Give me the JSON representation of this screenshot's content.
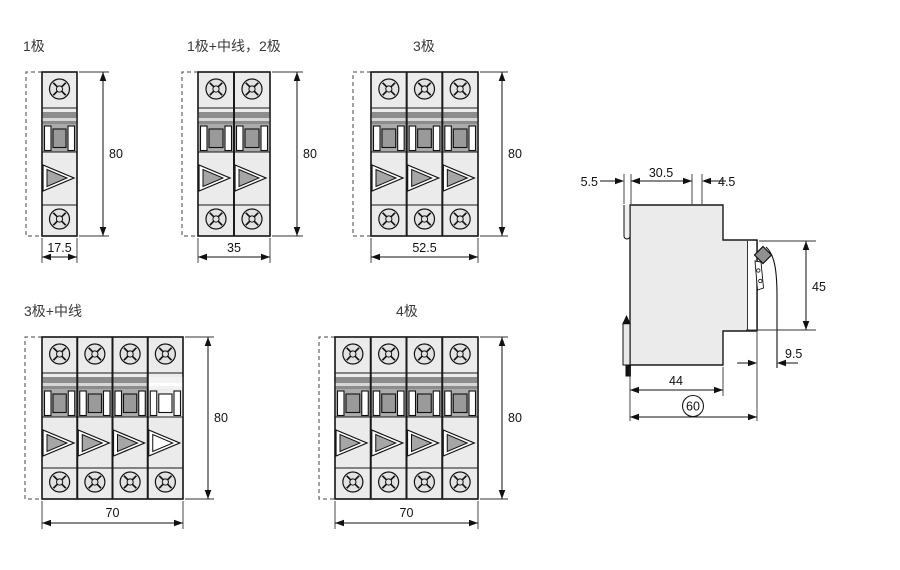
{
  "figure": {
    "subject": "miniature-circuit-breaker-dimension-drawing"
  },
  "panels": [
    {
      "title": "1极",
      "poles": 1,
      "width_mm": "17.5",
      "height_mm": "80",
      "neutral_last": false
    },
    {
      "title": "1极+中线，2极",
      "poles": 2,
      "width_mm": "35",
      "height_mm": "80",
      "neutral_last": false
    },
    {
      "title": "3极",
      "poles": 3,
      "width_mm": "52.5",
      "height_mm": "80",
      "neutral_last": false
    },
    {
      "title": "3极+中线",
      "poles": 4,
      "width_mm": "70",
      "height_mm": "80",
      "neutral_last": true
    },
    {
      "title": "4极",
      "poles": 4,
      "width_mm": "70",
      "height_mm": "80",
      "neutral_last": false
    }
  ],
  "side_view": {
    "clip_offset_mm": "5.5",
    "top_depth_mm": "30.5",
    "handle_depth_mm": "4.5",
    "front_height_mm": "45",
    "terminal_depth_mm": "9.5",
    "base_depth_mm": "44",
    "overall_depth_mm": "60"
  },
  "colors": {
    "body_fill": "#ebebeb",
    "toggle_band": "#ababab",
    "dark_stripe": "#8c8c8c",
    "handle_center": "#9a9a9a",
    "outline": "#1a1a1a"
  }
}
